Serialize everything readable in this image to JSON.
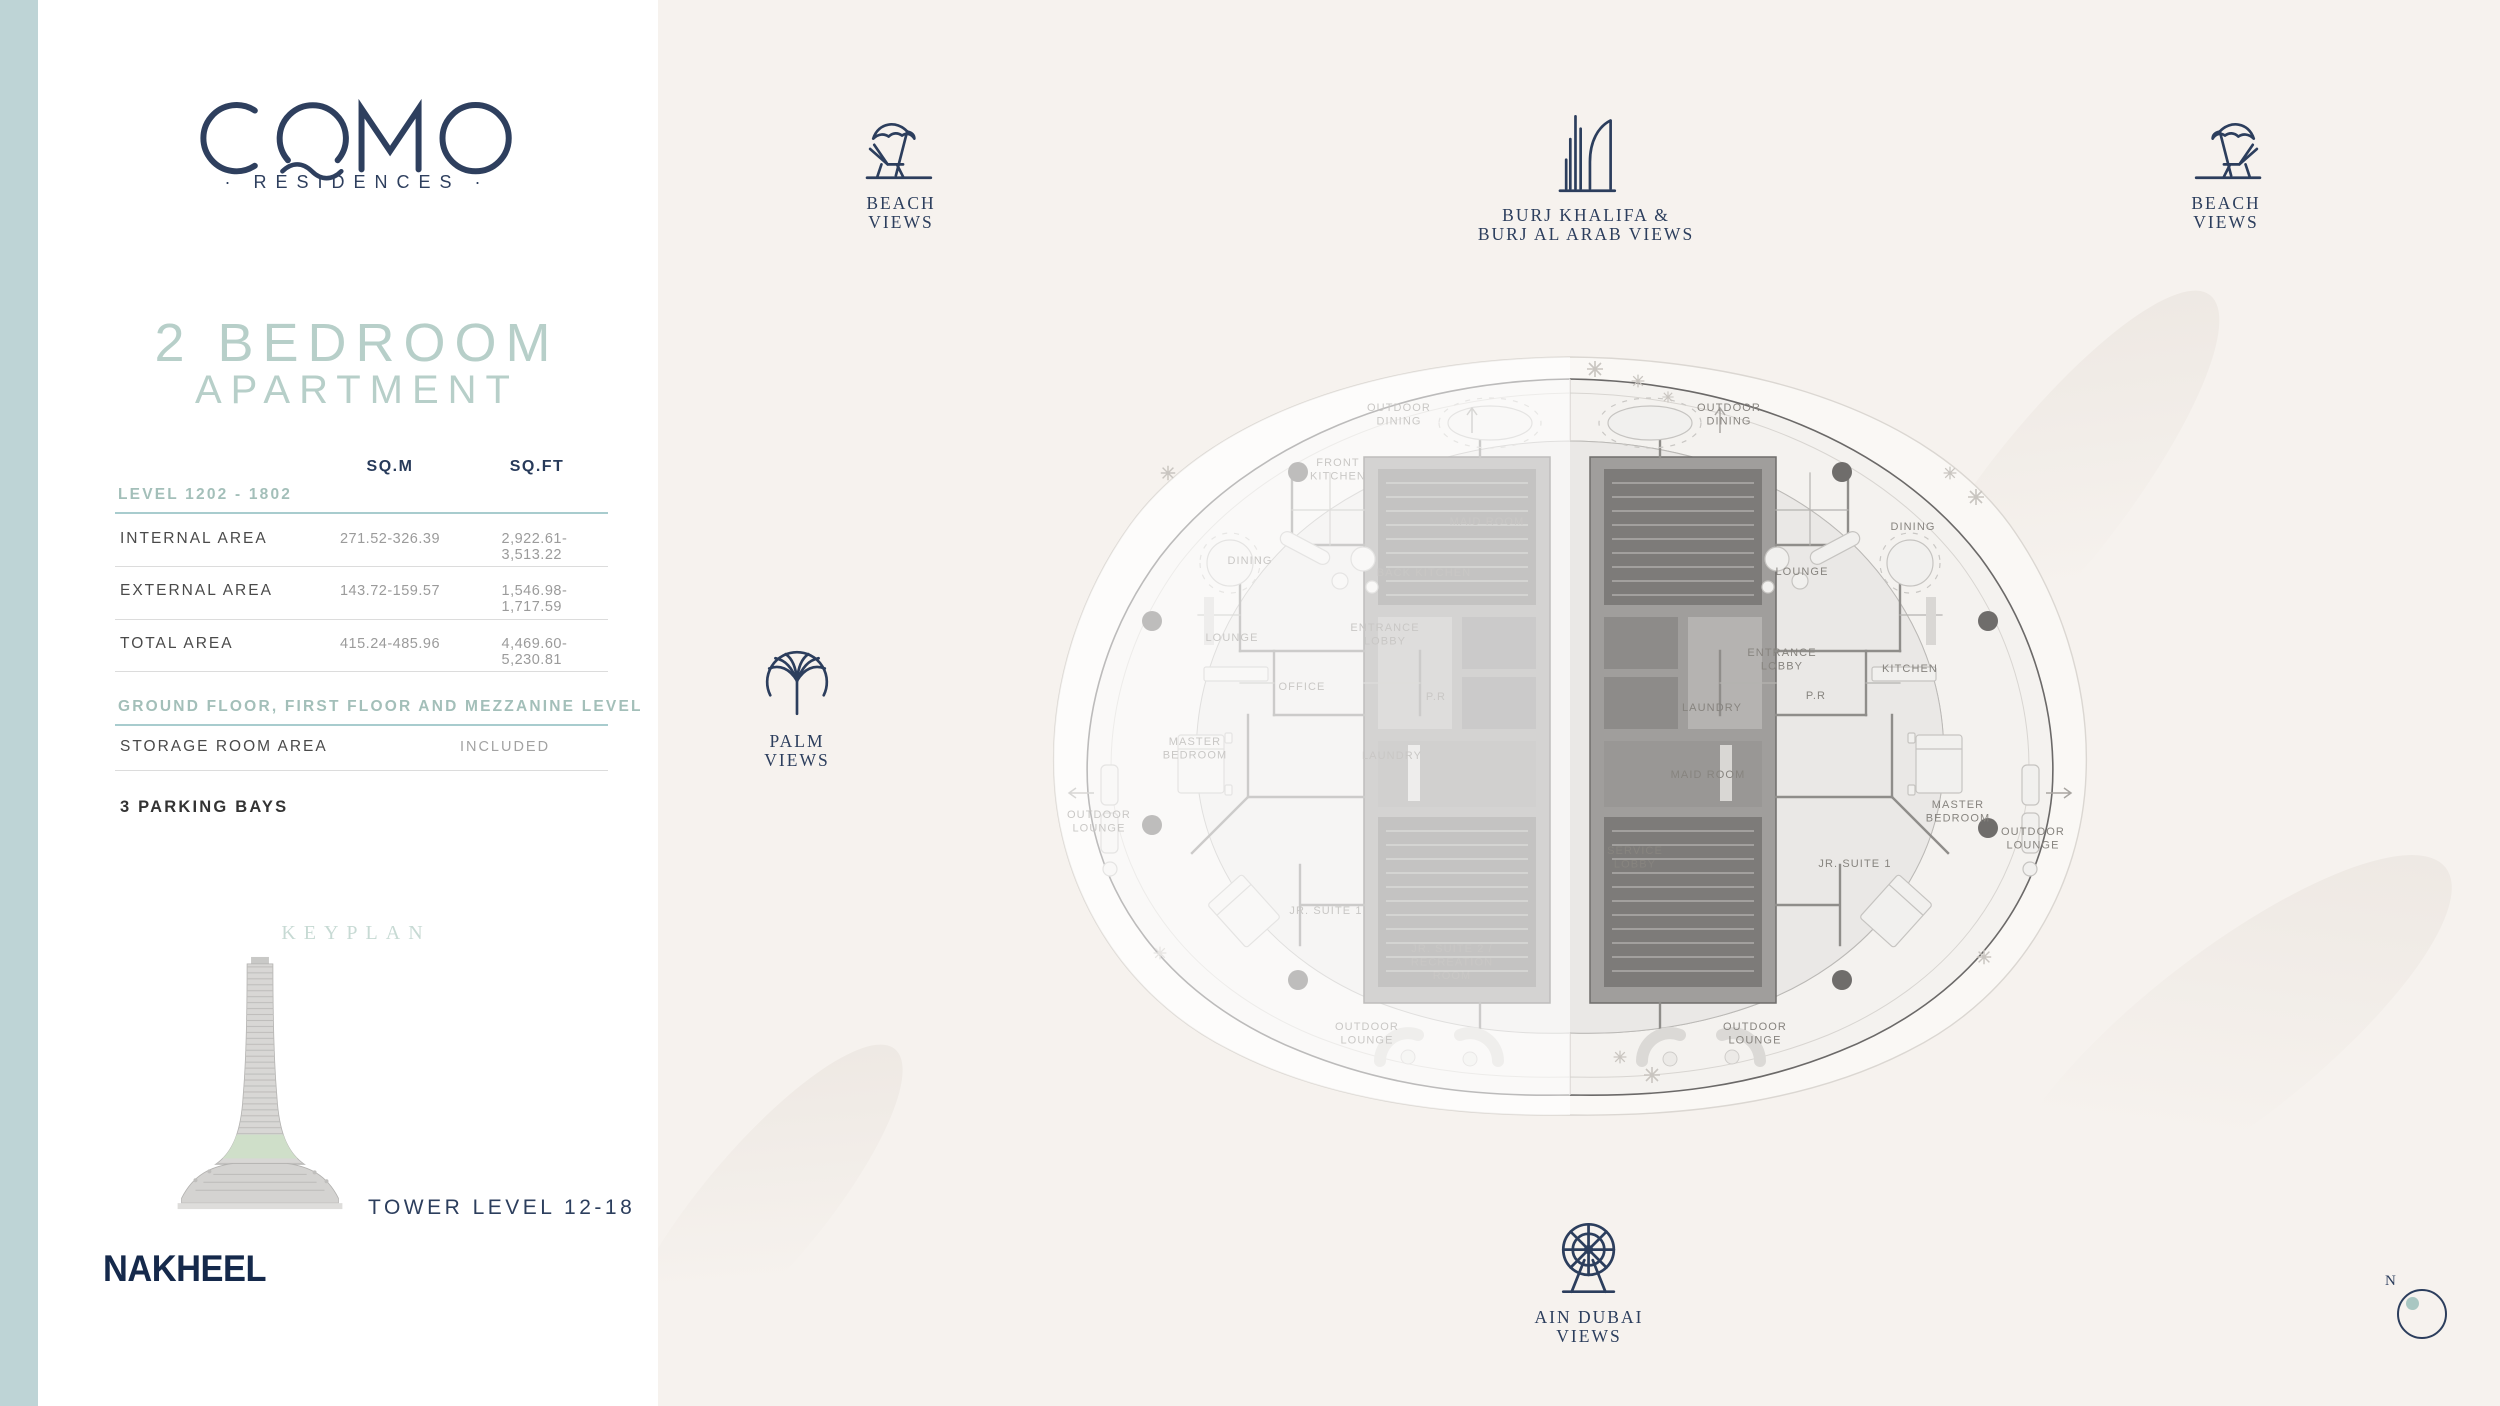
{
  "brand": {
    "logo": "COMO",
    "residences": "· RESIDENCES ·",
    "developer": "NAKHEEL"
  },
  "title": {
    "line1": "2 BEDROOM",
    "line2": "APARTMENT"
  },
  "area_table": {
    "col_sqm": "SQ.M",
    "col_sqft": "SQ.FT",
    "level_heading": "LEVEL 1202 - 1802",
    "rows": [
      {
        "label": "INTERNAL AREA",
        "sqm": "271.52-326.39",
        "sqft": "2,922.61-3,513.22"
      },
      {
        "label": "EXTERNAL AREA",
        "sqm": "143.72-159.57",
        "sqft": "1,546.98-1,717.59"
      },
      {
        "label": "TOTAL AREA",
        "sqm": "415.24-485.96",
        "sqft": "4,469.60-5,230.81"
      }
    ],
    "floor_heading": "GROUND FLOOR, FIRST FLOOR AND MEZZANINE LEVEL",
    "storage_label": "STORAGE ROOM AREA",
    "storage_value": "INCLUDED",
    "parking": "3 PARKING BAYS"
  },
  "keyplan": {
    "heading": "KEYPLAN",
    "tower_level": "TOWER LEVEL 12-18"
  },
  "views": {
    "beach_left": [
      "BEACH",
      "VIEWS"
    ],
    "burj": [
      "BURJ KHALIFA &",
      "BURJ AL ARAB VIEWS"
    ],
    "beach_right": [
      "BEACH",
      "VIEWS"
    ],
    "palm": [
      "PALM",
      "VIEWS"
    ],
    "ain_dubai": [
      "AIN DUBAI",
      "VIEWS"
    ],
    "compass_north": "N"
  },
  "floorplan": {
    "labels": [
      {
        "id": "l-outdoor-dining",
        "side": "left",
        "lines": [
          "OUTDOOR",
          "DINING"
        ]
      },
      {
        "id": "l-front-kitchen",
        "side": "left",
        "lines": [
          "FRONT",
          "KITCHEN"
        ]
      },
      {
        "id": "l-dining",
        "side": "left",
        "lines": [
          "DINING"
        ]
      },
      {
        "id": "l-maid-room",
        "side": "left",
        "lines": [
          "MAID ROOM"
        ]
      },
      {
        "id": "l-back-kitchen",
        "side": "left",
        "lines": [
          "BACK KITCHEN"
        ]
      },
      {
        "id": "l-lounge",
        "side": "left",
        "lines": [
          "LOUNGE"
        ]
      },
      {
        "id": "l-entrance-lobby",
        "side": "left",
        "lines": [
          "ENTRANCE",
          "LOBBY"
        ]
      },
      {
        "id": "l-office",
        "side": "left",
        "lines": [
          "OFFICE"
        ]
      },
      {
        "id": "l-pr",
        "side": "left",
        "lines": [
          "P.R"
        ]
      },
      {
        "id": "l-master-bedroom",
        "side": "left",
        "lines": [
          "MASTER",
          "BEDROOM"
        ]
      },
      {
        "id": "l-outdoor-lounge-west",
        "side": "left",
        "lines": [
          "OUTDOOR",
          "LOUNGE"
        ]
      },
      {
        "id": "l-laundry",
        "side": "left",
        "lines": [
          "LAUNDRY"
        ]
      },
      {
        "id": "l-jr-suite-1",
        "side": "left",
        "lines": [
          "JR. SUITE 1"
        ]
      },
      {
        "id": "l-jr-suite-2",
        "side": "left",
        "lines": [
          "JR. SUITE 2 /",
          "RECREATION",
          "ROOM"
        ]
      },
      {
        "id": "l-outdoor-lounge-south",
        "side": "left",
        "lines": [
          "OUTDOOR",
          "LOUNGE"
        ]
      },
      {
        "id": "r-outdoor-dining",
        "side": "right",
        "lines": [
          "OUTDOOR",
          "DINING"
        ]
      },
      {
        "id": "r-dining",
        "side": "right",
        "lines": [
          "DINING"
        ]
      },
      {
        "id": "r-lounge",
        "side": "right",
        "lines": [
          "LOUNGE"
        ]
      },
      {
        "id": "r-entrance-lobby",
        "side": "right",
        "lines": [
          "ENTRANCE",
          "LOBBY"
        ]
      },
      {
        "id": "r-kitchen",
        "side": "right",
        "lines": [
          "KITCHEN"
        ]
      },
      {
        "id": "r-pr",
        "side": "right",
        "lines": [
          "P.R"
        ]
      },
      {
        "id": "r-laundry",
        "side": "right",
        "lines": [
          "LAUNDRY"
        ]
      },
      {
        "id": "r-maid-room",
        "side": "right",
        "lines": [
          "MAID ROOM"
        ]
      },
      {
        "id": "r-service-lobby",
        "side": "right",
        "lines": [
          "SERVICE",
          "LOBBY"
        ]
      },
      {
        "id": "r-jr-suite-1",
        "side": "right",
        "lines": [
          "JR. SUITE 1"
        ]
      },
      {
        "id": "r-master-bedroom",
        "side": "right",
        "lines": [
          "MASTER",
          "BEDROOM"
        ]
      },
      {
        "id": "r-outdoor-lounge-east",
        "side": "right",
        "lines": [
          "OUTDOOR",
          "LOUNGE"
        ]
      },
      {
        "id": "r-outdoor-lounge-south",
        "side": "right",
        "lines": [
          "OUTDOOR",
          "LOUNGE"
        ]
      }
    ]
  },
  "colors": {
    "accent_navy": "#2c3e5d",
    "nakheel_navy": "#15294b",
    "sage_title": "#b7cfc9",
    "teal_rule": "#a8ccce",
    "left_band": "#bed4d6",
    "background": "#f6f2ee",
    "keyplan_band_green": "#cfdfc9"
  }
}
